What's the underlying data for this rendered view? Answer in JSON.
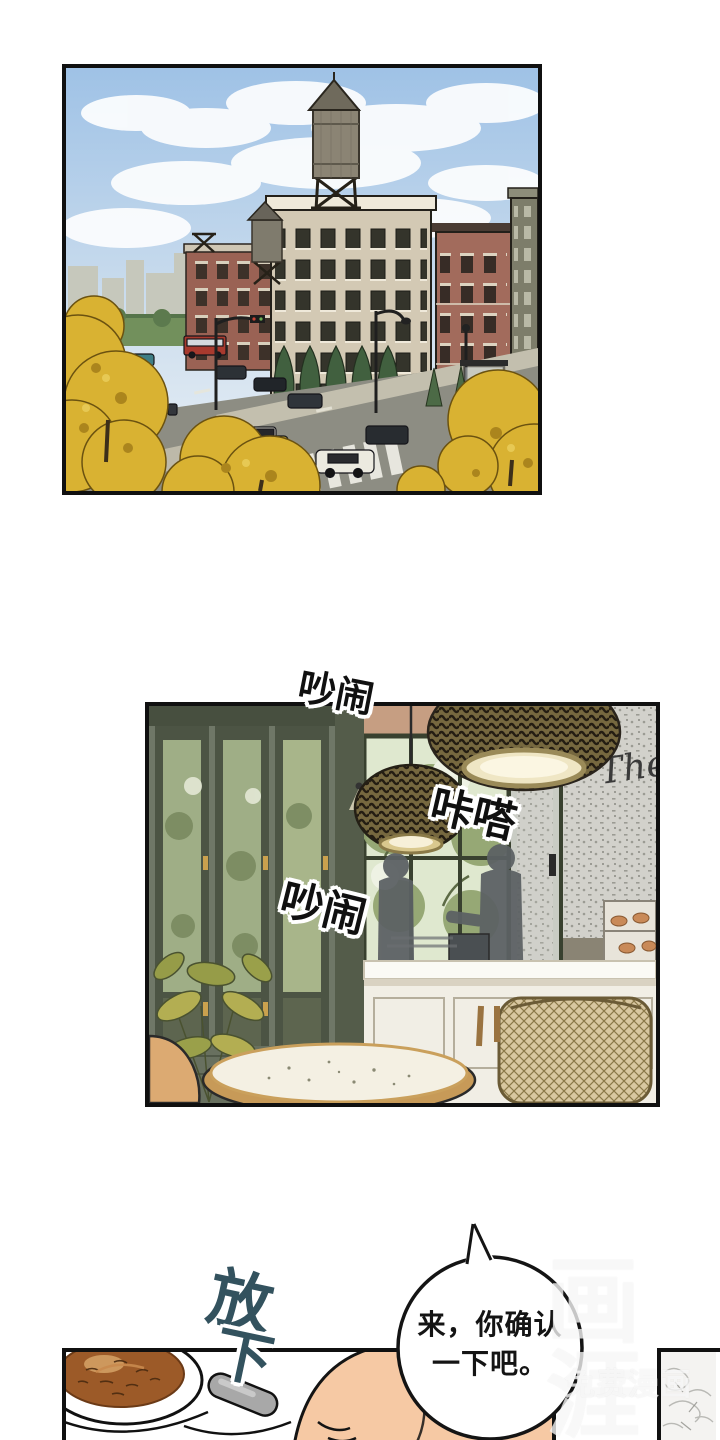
{
  "comic": {
    "sfx": {
      "noise_top": "吵闹",
      "click": "咔嗒",
      "noise_mid": "吵闹",
      "put_down": {
        "char1": "放",
        "char2": "下"
      }
    },
    "speech_bubble": {
      "line1": "来，你确认",
      "line2": "一下吧。"
    },
    "cafe_wall_sign": "The",
    "watermark": {
      "logo": "画涯",
      "tagline": "免费漫画"
    },
    "colors": {
      "panel_border": "#101010",
      "sfx_black": "#101010",
      "sfx_putdown_teal": "#33525e",
      "sky_blue": "#a9c7e6",
      "autumn_yellow": "#d9b232",
      "brick_red": "#a26b5c",
      "cafe_green": "#6f7767",
      "coffee_brown": "#9c5a28",
      "skin_tone": "#f6c9a4",
      "watermark_white": "#ffffff"
    }
  }
}
